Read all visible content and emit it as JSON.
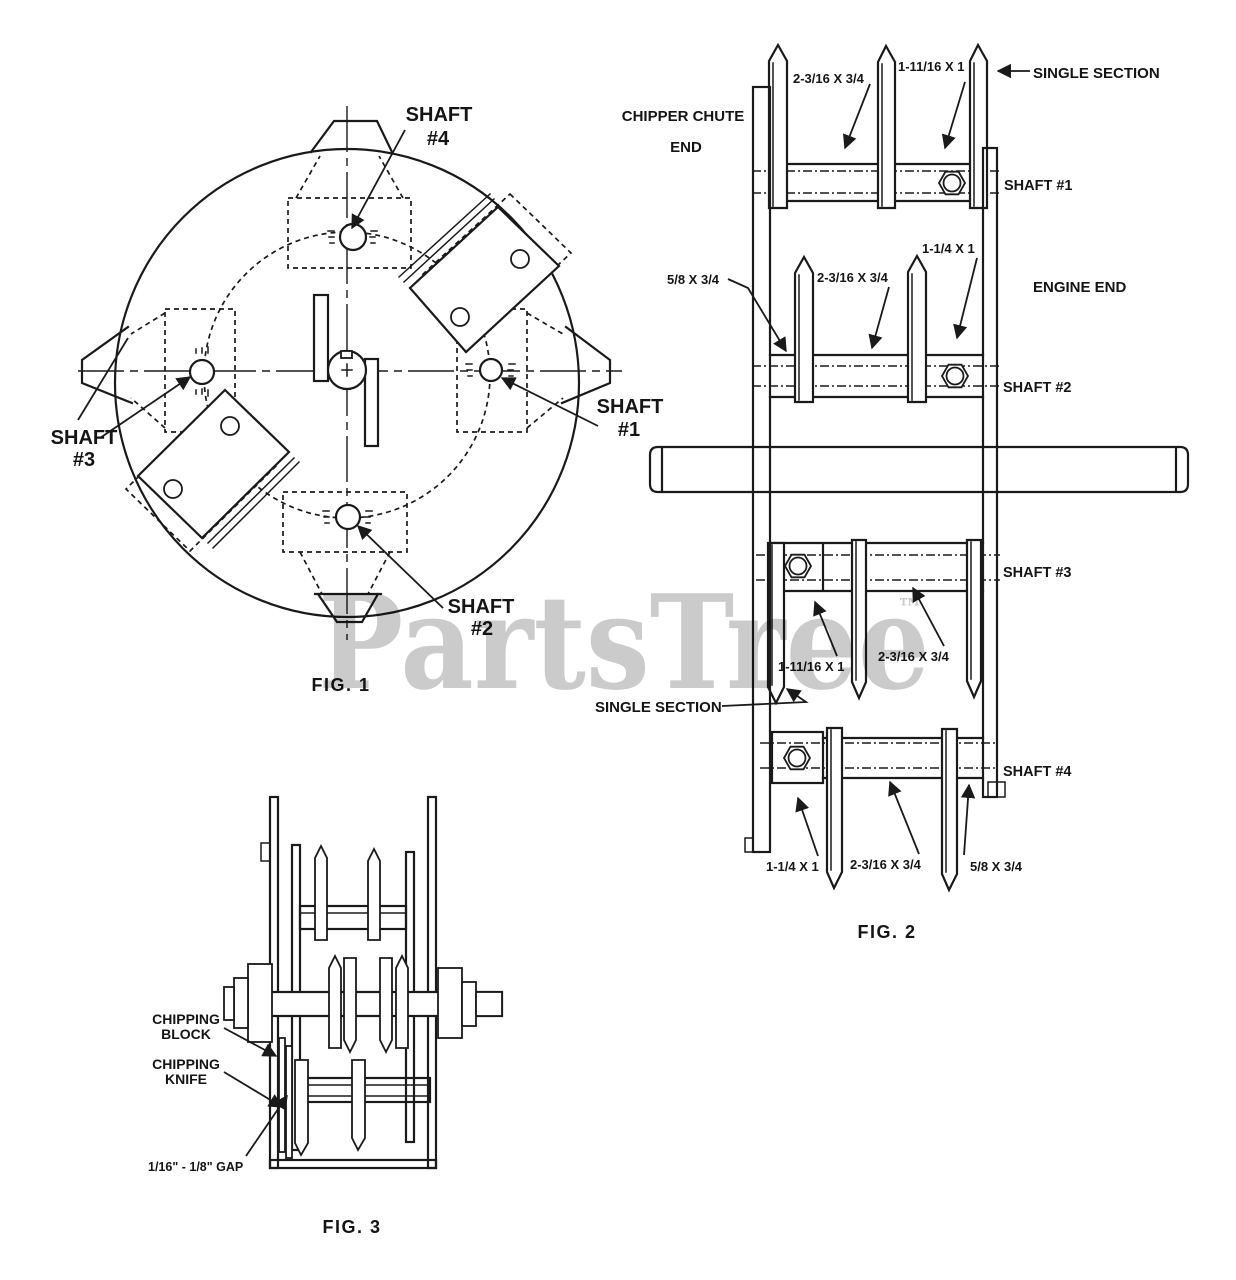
{
  "colors": {
    "ink": "#1a1a1a",
    "watermark": "#cbcbcb",
    "background": "#ffffff"
  },
  "watermark": {
    "text": "PartsTree",
    "tm": "™"
  },
  "fig1": {
    "caption": "FIG. 1",
    "labels": {
      "shaft4": [
        "SHAFT",
        "#4"
      ],
      "shaft1": [
        "SHAFT",
        "#1"
      ],
      "shaft2": [
        "SHAFT",
        "#2"
      ],
      "shaft3": [
        "SHAFT",
        "#3"
      ]
    }
  },
  "fig2": {
    "caption": "FIG. 2",
    "ends": {
      "chipper": [
        "CHIPPER CHUTE",
        "END"
      ],
      "engine": "ENGINE END"
    },
    "single_section": {
      "top": "SINGLE SECTION",
      "left": "SINGLE SECTION"
    },
    "shafts": [
      "SHAFT #1",
      "SHAFT #2",
      "SHAFT #3",
      "SHAFT #4"
    ],
    "dims": {
      "row1_a": "2-3/16 X 3/4",
      "row1_b": "1-11/16 X 1",
      "row2_a": "5/8 X 3/4",
      "row2_b": "2-3/16 X 3/4",
      "row2_c": "1-1/4 X 1",
      "row3_a": "1-11/16 X 1",
      "row3_b": "2-3/16 X 3/4",
      "row4_a": "1-1/4 X 1",
      "row4_b": "2-3/16 X 3/4",
      "row4_c": "5/8 X 3/4"
    }
  },
  "fig3": {
    "caption": "FIG. 3",
    "labels": {
      "chipping_block": [
        "CHIPPING",
        "BLOCK"
      ],
      "chipping_knife": [
        "CHIPPING",
        "KNIFE"
      ],
      "gap": "1/16\" - 1/8\" GAP"
    }
  }
}
